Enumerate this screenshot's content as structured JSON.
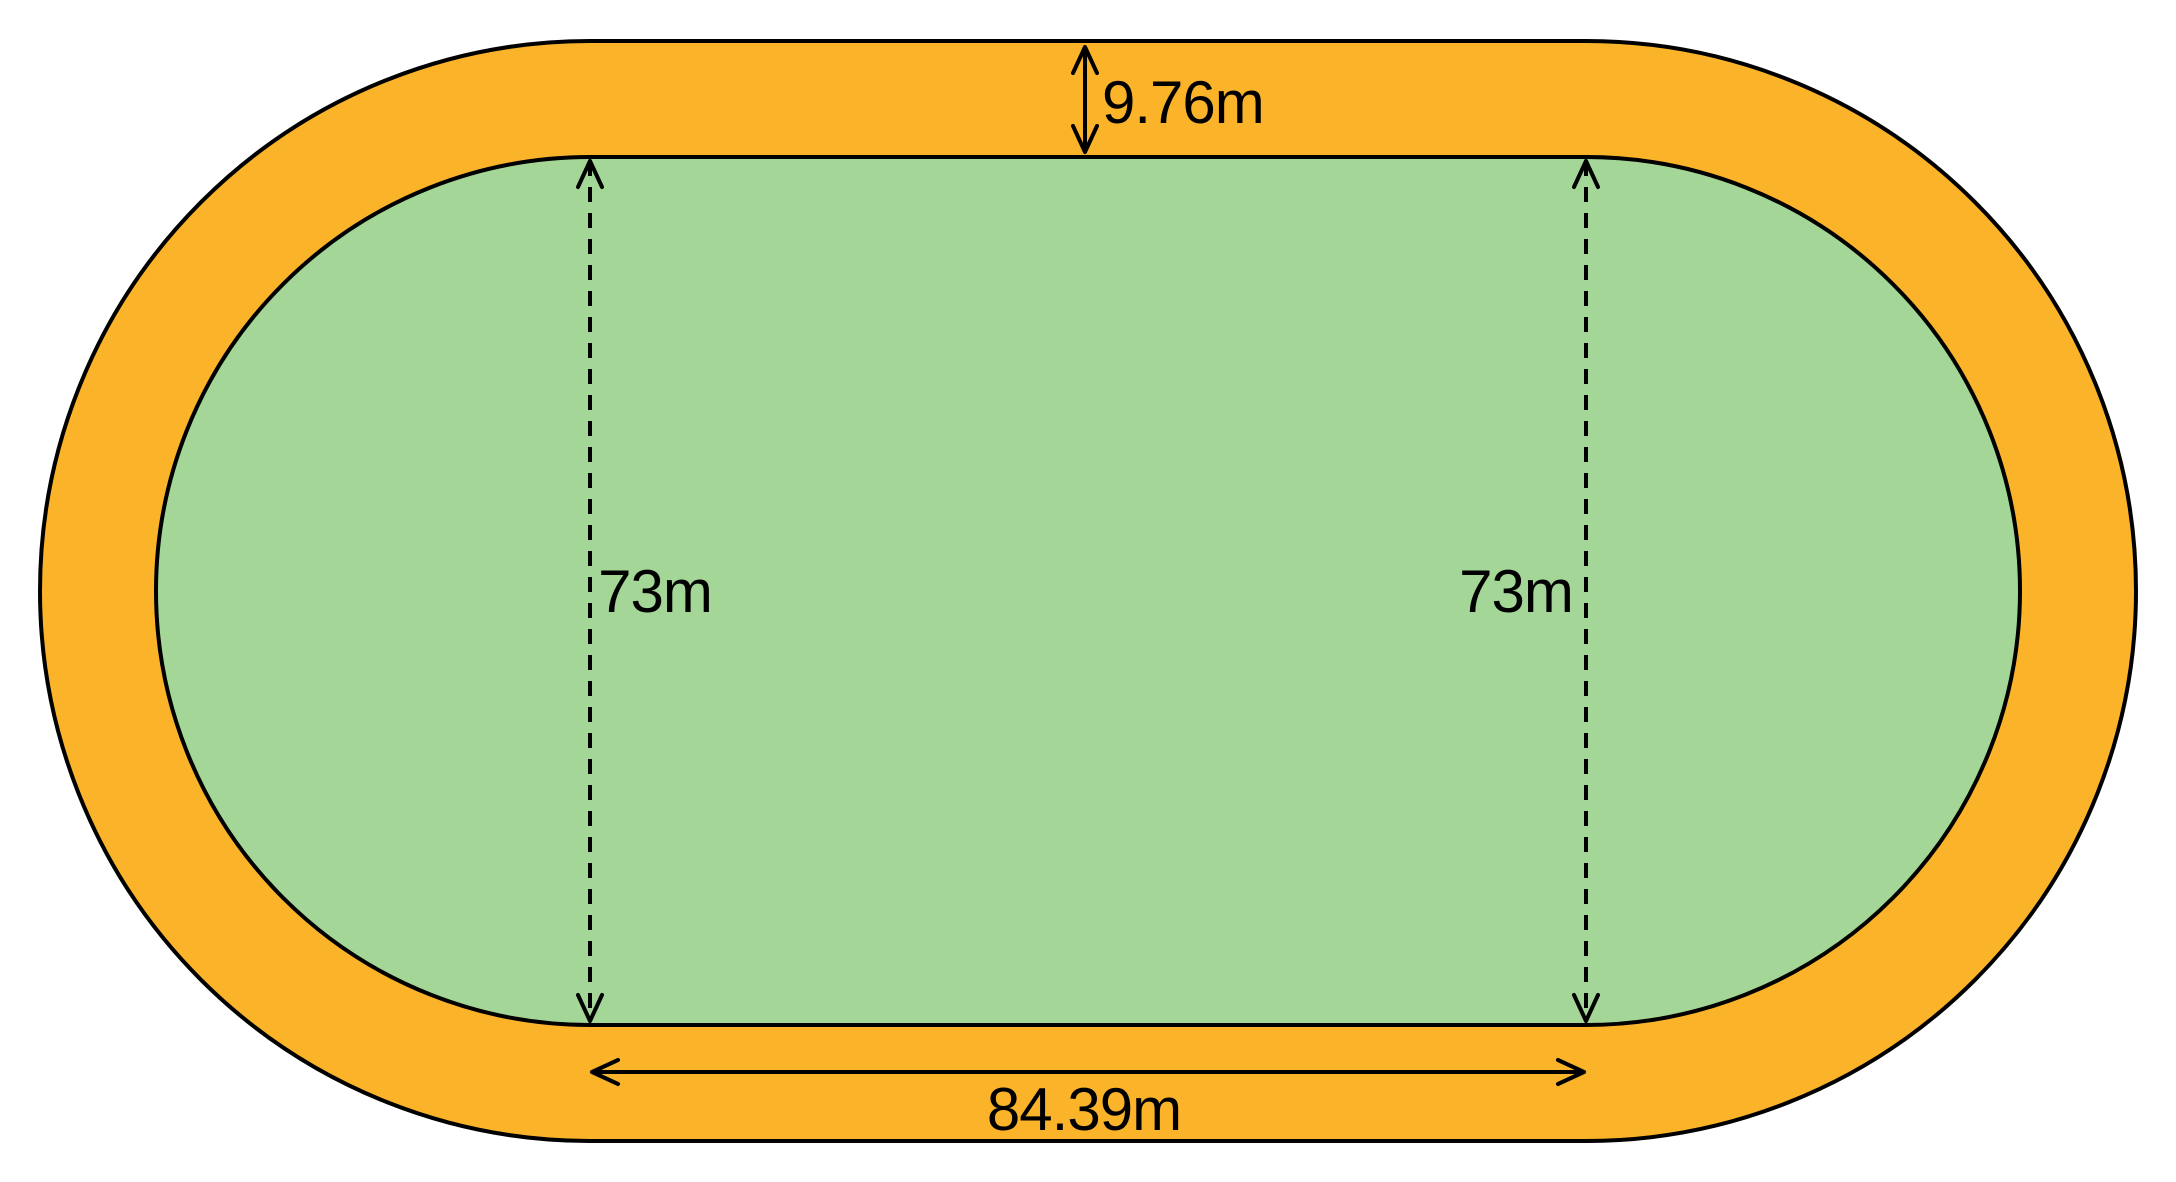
{
  "diagram": {
    "title": "Oval running track with dimensions",
    "labels": {
      "track_width": "9.76m",
      "field_height_left": "73m",
      "field_height_right": "73m",
      "straight_length": "84.39m"
    },
    "colors": {
      "track": "#FBB32A",
      "field": "#A3D697",
      "outline": "#000000",
      "background": "#FFFFFF"
    }
  }
}
